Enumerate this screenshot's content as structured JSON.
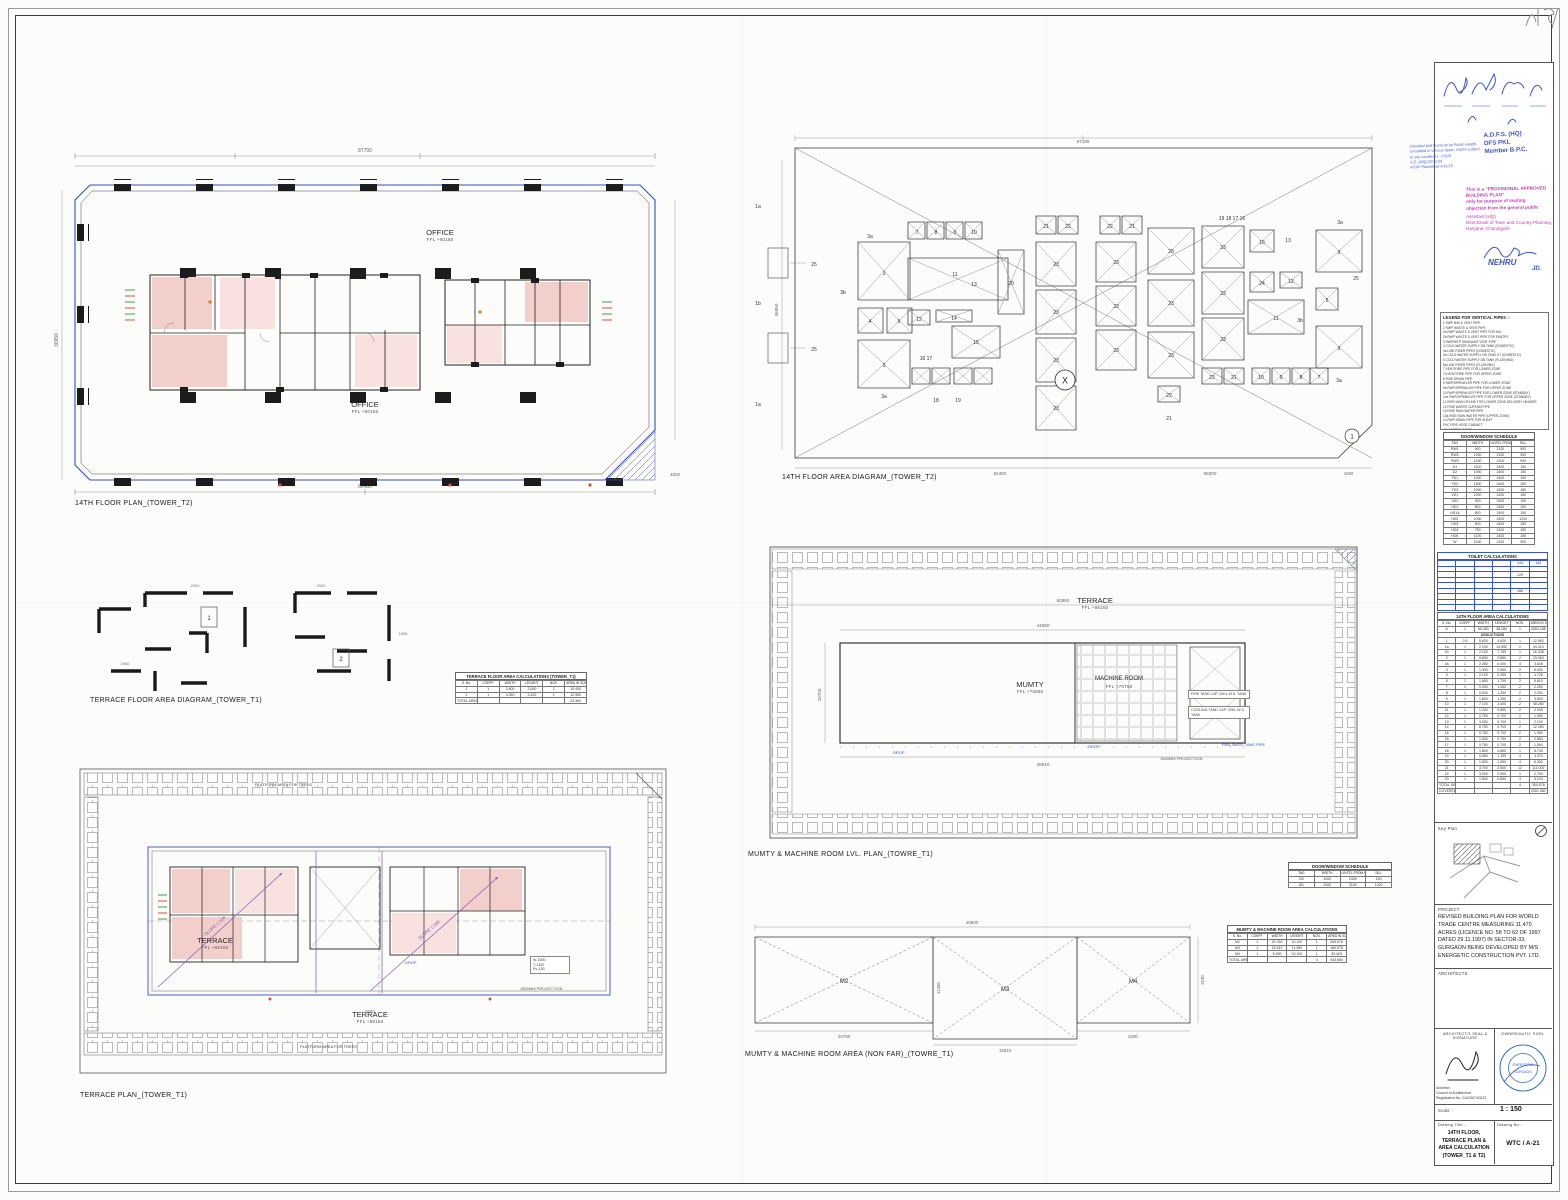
{
  "captions": {
    "floor_plan_t2": "14TH FLOOR PLAN_(TOWER_T2)",
    "area_diagram_t2": "14TH FLOOR AREA DIAGRAM_(TOWER_T2)",
    "terrace_area_diagram_t1": "TERRACE FLOOR AREA DIAGRAM_(TOWER_T1)",
    "terrace_plan_t1": "TERRACE PLAN_(TOWER_T1)",
    "mumty_plan_t1": "MUMTY & MACHINE ROOM LVL. PLAN_(TOWRE_T1)",
    "mumty_area_t1": "MUMTY & MACHINE ROOM AREA (NON FAR)_(TOWRE_T1)"
  },
  "floor_plan": {
    "office1": {
      "name": "OFFICE",
      "ffl": "FFL +60150"
    },
    "office2": {
      "name": "OFFICE",
      "ffl": "FFL +60150"
    },
    "dims": {
      "top": "87700",
      "bottom": "62480",
      "left": "36950",
      "corner": "4820"
    }
  },
  "area_diagram": {
    "labels": [
      "1a",
      "25",
      "1b",
      "25",
      "1a",
      "3a",
      "3",
      "7",
      "8",
      "9",
      "10",
      "11",
      "13",
      "3b",
      "4",
      "5",
      "12",
      "14",
      "15",
      "16 17",
      "3",
      "18",
      "19",
      "3a",
      "21",
      "22",
      "20",
      "23",
      "23",
      "23",
      "23",
      "22",
      "21",
      "23",
      "23",
      "23",
      "23",
      "23",
      "23",
      "22",
      "21",
      "19 18 17 16",
      "23",
      "23",
      "23",
      "16",
      "13",
      "24",
      "12",
      "11",
      "22",
      "21",
      "10",
      "9",
      "8",
      "7",
      "3a",
      "3",
      "5",
      "3",
      "3b",
      "3a",
      "25"
    ],
    "x_marker": "X",
    "corner_marker": "1",
    "dims": {
      "top": "87195",
      "top2": "66000",
      "bottom": "62480",
      "bottom2": "66000",
      "left": "36950",
      "corner": "4820"
    }
  },
  "fragments": {
    "box1": "1",
    "box2": "2",
    "dims": [
      "2000",
      "3960",
      "2000",
      "1985"
    ]
  },
  "terrace_plan": {
    "terrace1": {
      "name": "TERRACE",
      "ffl": "FFL +66150"
    },
    "terrace2": {
      "name": "TERRACE",
      "ffl": "FFL +66150"
    },
    "planter_top": "PLATFORM AREA FOR TREES",
    "planter_bottom": "PLATFORM AREA FOR TREES",
    "slope": "SLOPE 1:100",
    "drop": "DROP",
    "projection": "1500MM PROJECTION",
    "note": [
      "W-1500",
      "T-1300",
      "Rv-150"
    ],
    "dims": {
      "bottom": "9000"
    }
  },
  "mumty_plan": {
    "terrace": {
      "name": "TERRACE",
      "ffl": "FFL +66150"
    },
    "mumty": {
      "name": "MUMTY",
      "ffl": "FFL +70650"
    },
    "machine": {
      "name": "MACHINE ROOM",
      "ffl": "FFL +70750"
    },
    "note1": "FIRE TANK CAP. 20KL W.S. TANK",
    "note2": "COOLING TANK CAP. 20KL W.S. TANK",
    "drop": "DROP",
    "projection": "1500MM PROJECTION",
    "pipe_note": "RWL 3NOS. TAKE PIPE",
    "dims": {
      "outer": "60950",
      "inner": "44950",
      "bottom": "38810",
      "left": "20700"
    }
  },
  "nonfar": {
    "m2": "M2",
    "m3": "M3",
    "m4": "M4",
    "dims": {
      "top": "46900",
      "m2": "20760",
      "m3": "15910",
      "m4": "5290",
      "right": "3190",
      "m3h": "11350"
    }
  },
  "tables": {
    "legend": {
      "title": "LEGEND FOR VERTICAL PIPES :-",
      "items": [
        "1  RWP B/W & VENT PIPE",
        "2  RWP WASTE & VENT PIPE",
        "2a RWP WASTE & VENT PIPE FOR W/L",
        "2b RWP WASTE & VENT PIPE FOR PANTRY",
        "3  RWP/WTP DRAINAGE VENT PIPE",
        "4  COLD WATER SUPPLY DN TANK (DOMESTIC)",
        "4a LINE RISER PIPES (DOMESTIC)",
        "4b COLD WATER SUPPLY DN TANK HT (DOMESTIC)",
        "5  COLD WATER SUPPLY DN TANK (FLUSHING)",
        "5a LINE RISER PIPES (FLUSHING)",
        "7  VENT/FIRE PIPE FOR LOWER ZONE",
        "7a VENT/FIRE PIPE FOR UPPER ZONE",
        "8  RISE DRAIN PIPE",
        "9  RWP/SPRINKLER PIPE FOR LOWER ZONE",
        "9a RWP/SPRINKLER PIPE FOR UPPER ZONE",
        "10 RWP/SPRINKLER PIPE FOR LOWER ZONE (STANDBY)",
        "10a RWP/SPRINKLER PIPE FOR UPPER ZONE (STANDBY)",
        "11 RISE MAIN UPLINE FOR LOWER ZONE DELIVERY HEADER",
        "12 RISE WATER CURTAIN PIPE",
        "13 RISE RAIN WATER PIPE",
        "13a RISE RAIN WATER PIPE (UPPER ZONE)",
        "14 RWP DRAIN PIPE FOR SHAFT",
        "FHC FIRE HOSE CABINET",
        "AD ACCESS DOOR"
      ]
    },
    "door_schedule": {
      "title": "DOOR/WINDOW SCHEDULE",
      "headers": [
        "TAG",
        "WIDTH",
        "LINTEL FROM FFL",
        "SILL"
      ],
      "rows": [
        [
          "RW1",
          "900",
          "2100",
          "900"
        ],
        [
          "RW2",
          "1200",
          "2100",
          "900"
        ],
        [
          "RW3",
          "1200",
          "2100",
          "900"
        ],
        [
          "D1",
          "1100",
          "2400",
          "150"
        ],
        [
          "D2",
          "1000",
          "2400",
          "150"
        ],
        [
          "FD1",
          "1200",
          "2400",
          "150"
        ],
        [
          "FD2",
          "1500",
          "2400",
          "150"
        ],
        [
          "FD3",
          "1000",
          "2400",
          "150"
        ],
        [
          "VD1",
          "1200",
          "2400",
          "150"
        ],
        [
          "VD2",
          "900",
          "2400",
          "150"
        ],
        [
          "HD1",
          "800",
          "2400",
          "150"
        ],
        [
          "HD1A",
          "800",
          "2400",
          "150"
        ],
        [
          "HD2",
          "1000",
          "2400",
          "1200"
        ],
        [
          "HD3",
          "900",
          "2400",
          "150"
        ],
        [
          "HD4",
          "750",
          "2400",
          "150"
        ],
        [
          "HD5",
          "1100",
          "2400",
          "150"
        ],
        [
          "W",
          "1000",
          "2100",
          "900"
        ]
      ]
    },
    "toilet": {
      "title": "TOILET CALCULATIONS",
      "rows": [
        [
          "",
          "",
          "",
          "",
          "144",
          "140"
        ],
        [
          "",
          "",
          "",
          "",
          "",
          ""
        ],
        [
          "",
          "",
          "",
          "",
          "125",
          ""
        ],
        [
          "",
          "",
          "",
          "",
          "",
          ""
        ],
        [
          "",
          "",
          "",
          "",
          "",
          ""
        ],
        [
          "",
          "",
          "",
          "",
          "186",
          ""
        ],
        [
          "",
          "",
          "",
          "",
          "",
          ""
        ],
        [
          "",
          "",
          "",
          "",
          "",
          ""
        ],
        [
          "",
          "",
          "",
          "",
          "",
          ""
        ]
      ]
    },
    "floor_area": {
      "title": "14TH FLOOR AREA CALCULATIONS",
      "headers": [
        "S. No.",
        "COEFF.",
        "WIDTH",
        "LENGHT",
        "NOS.",
        "AREA IN SQMT"
      ],
      "rows": [
        [
          "A",
          "1",
          "69.280",
          "38.280",
          "1",
          "2652.038"
        ],
        [
          "DEDUCTIONS"
        ],
        [
          "1",
          "0.5",
          "5.620",
          "4.620",
          "1",
          "12.982"
        ],
        [
          "1a",
          "1",
          "2.100",
          "10.550",
          "2",
          "44.310"
        ],
        [
          "1b",
          "1",
          "2.100",
          "7.780",
          "1",
          "16.338"
        ],
        [
          "2",
          "1",
          "5.800",
          "2.850",
          "2",
          "33.060"
        ],
        [
          "2a",
          "1",
          "2.280",
          "0.400",
          "4",
          "3.648"
        ],
        [
          "3",
          "1",
          "1.300",
          "2.550",
          "2",
          "6.630"
        ],
        [
          "4",
          "1",
          "2.100",
          "2.250",
          "1",
          "4.725"
        ],
        [
          "5",
          "1",
          "1.650",
          "1.700",
          "2",
          "5.610"
        ],
        [
          "7",
          "1",
          "0.900",
          "1.250",
          "2",
          "2.250"
        ],
        [
          "8",
          "1",
          "0.900",
          "1.250",
          "2",
          "2.250"
        ],
        [
          "9",
          "1",
          "1.800",
          "1.250",
          "2",
          "4.500"
        ],
        [
          "10",
          "1",
          "7.100",
          "3.400",
          "2",
          "48.280"
        ],
        [
          "11",
          "1",
          "1.200",
          "0.850",
          "2",
          "2.040"
        ],
        [
          "12",
          "1",
          "0.750",
          "0.700",
          "2",
          "1.050"
        ],
        [
          "13",
          "1",
          "3.000",
          "0.700",
          "1",
          "2.100"
        ],
        [
          "14",
          "1",
          "8.750",
          "0.700",
          "2",
          "12.250"
        ],
        [
          "15",
          "1",
          "0.750",
          "0.700",
          "2",
          "1.050"
        ],
        [
          "16",
          "1",
          "1.900",
          "0.750",
          "2",
          "2.850"
        ],
        [
          "17",
          "1",
          "0.750",
          "0.700",
          "2",
          "1.050"
        ],
        [
          "18",
          "1",
          "1.800",
          "4.850",
          "1",
          "8.730"
        ],
        [
          "19",
          "1",
          "0.950",
          "1.150",
          "4",
          "4.370"
        ],
        [
          "20",
          "1",
          "1.500",
          "1.050",
          "4",
          "6.300"
        ],
        [
          "21",
          "1",
          "3.700",
          "2.500",
          "12",
          "111.000"
        ],
        [
          "22",
          "1",
          "3.000",
          "0.900",
          "1",
          "2.700"
        ],
        [
          "23",
          "1",
          "1.500",
          "0.850",
          "4",
          "5.100"
        ],
        [
          "TOTAL DEDUCTIONS (B)",
          "",
          "",
          "",
          "4",
          "350.578"
        ],
        [
          "COVERED AREA = (A - B)",
          "",
          "",
          "",
          "",
          "2301.460"
        ]
      ]
    },
    "terrace_area": {
      "title": "TERRACE FLOOR AREA CALCULATIONS (TOWER_T1)",
      "headers": [
        "S. No.",
        "COEFF.",
        "WIDTH",
        "LENGHT",
        "NOS.",
        "AREA IN SQMT"
      ],
      "rows": [
        [
          "1",
          "1",
          "2.600",
          "2.000",
          "2",
          "10.400"
        ],
        [
          "2",
          "1",
          "4.050",
          "3.200",
          "1",
          "12.960"
        ],
        [
          "TOTAL AREA",
          "",
          "",
          "",
          "",
          "23.360"
        ]
      ]
    },
    "mumty_area": {
      "title": "MUMTY & MACHINE ROOM AREA CALCULATIONS",
      "headers": [
        "S. No.",
        "COEFF.",
        "WIDTH",
        "LENGHT",
        "NOS.",
        "AREA IN SQMT"
      ],
      "rows": [
        [
          "M2",
          "1",
          "20.760",
          "10.100",
          "1",
          "209.676"
        ],
        [
          "M3",
          "1",
          "15.910",
          "11.350",
          "1",
          "180.578"
        ],
        [
          "M4",
          "1",
          "5.290",
          "10.100",
          "1",
          "53.429"
        ],
        [
          "TOTAL AREA",
          "",
          "",
          "",
          "3",
          "443.683"
        ]
      ]
    },
    "door_schedule_small": {
      "title": "DOOR/WINDOW SCHEDULE",
      "headers": [
        "TAG",
        "WIDTH",
        "LINTEL FROM FFL",
        "SILL"
      ],
      "rows": [
        [
          "D5",
          "1000",
          "2400",
          "150"
        ],
        [
          "W1",
          "2400",
          "2100",
          "1200"
        ]
      ]
    }
  },
  "title_block": {
    "stamps": {
      "adfs": [
        "A.D.F.S. (HQ)",
        "DFS PKL",
        "Member B.P.C."
      ],
      "ph_note": [
        "Checked and found ok by Public Health",
        "circulated to various depts. HUDA subject",
        "to site conditions  -73026",
        "S.E. (HQ)  22/11/19",
        "HSVP Panchkula   4/11/19"
      ],
      "provisional": [
        "This is a \"PROVISIONAL APPROVED BUILDING PLAN\"",
        "only for purpose of inviting",
        "objection from the general public"
      ],
      "dtcp": [
        "Assistant (HQ)",
        "Directorate of Town and Country Planning,",
        "Haryana, Chandigarh"
      ],
      "nehru": "NEHRU",
      "nehru_title": "JD."
    },
    "key_plan_label": "Key Plan",
    "project_label": "PROJECT",
    "project_text": "REVISED BUILDING PLAN FOR WORLD TRADE CENTRE MEASURING 11.470 ACRES (LICENCE NO. 58 TO 62 OF 1997 DATED 29.11.1997) IN SECTOR-33, GURGAON BEING DEVELOPED BY M/S ENERGETIC CONSTRUCTION PVT. LTD.",
    "architects_label": "ARCHITECTS",
    "seal_label": "ARCHITECT'S SEAL & SIGNATURE",
    "owner_label": "OWNER/AUTH. SIGN.",
    "registration": [
      "Architect",
      "Council of Architecture",
      "Registration No. CA/2007/40222"
    ],
    "stamp_text1": "ENERGETIC",
    "stamp_text2": "GURGAON",
    "scale_label": "Scale :",
    "scale_value": "1 : 150",
    "title_label": "Drawing Title:-",
    "number_label": "Drawing No:-",
    "drawing_title": "14TH FLOOR, TERRACE PLAN &\nAREA CALCULATION\n(TOWER_T1 & T2)",
    "drawing_number": "WTC / A-21"
  }
}
